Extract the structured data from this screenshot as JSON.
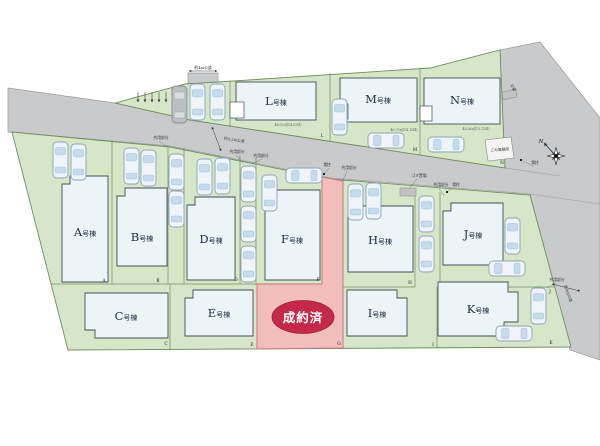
{
  "plan": {
    "sold_badge": "成約済",
    "compass_north": "N",
    "buildings": [
      {
        "letter": "A",
        "suffix": "号棟"
      },
      {
        "letter": "B",
        "suffix": "号棟"
      },
      {
        "letter": "C",
        "suffix": "号棟"
      },
      {
        "letter": "D",
        "suffix": "号棟"
      },
      {
        "letter": "E",
        "suffix": "号棟"
      },
      {
        "letter": "F",
        "suffix": "号棟"
      },
      {
        "letter": "H",
        "suffix": "号棟"
      },
      {
        "letter": "I",
        "suffix": "号棟"
      },
      {
        "letter": "J",
        "suffix": "号棟"
      },
      {
        "letter": "K",
        "suffix": "号棟"
      },
      {
        "letter": "L",
        "suffix": "号棟"
      },
      {
        "letter": "M",
        "suffix": "号棟"
      },
      {
        "letter": "N",
        "suffix": "号棟"
      }
    ],
    "lot_markers": [
      "A",
      "B",
      "C",
      "D",
      "E",
      "F",
      "G",
      "H",
      "I",
      "J",
      "K",
      "L",
      "M",
      "N"
    ],
    "roads": {
      "top_stub": "約4m公道",
      "main": "約4.2m公道",
      "right": "約4m公道",
      "upper_right": "公道"
    },
    "annotations": {
      "shared": "共用部分",
      "utility_pole": "電柱",
      "garbage_box": "ゴミ置場",
      "garbage_station": "ごみ集積所"
    },
    "areas": {
      "L": "46.05㎡(14.02坪)",
      "M": "46.79㎡(14.15坪)",
      "N": "45.36㎡(13.72坪)"
    },
    "colors": {
      "lot_green": "#d6e7c9",
      "road_gray": "#c9cacc",
      "sold_red": "#c5294a",
      "sold_lot_pink": "#f1bdbd",
      "building_fill": "#ebf4f6"
    }
  }
}
